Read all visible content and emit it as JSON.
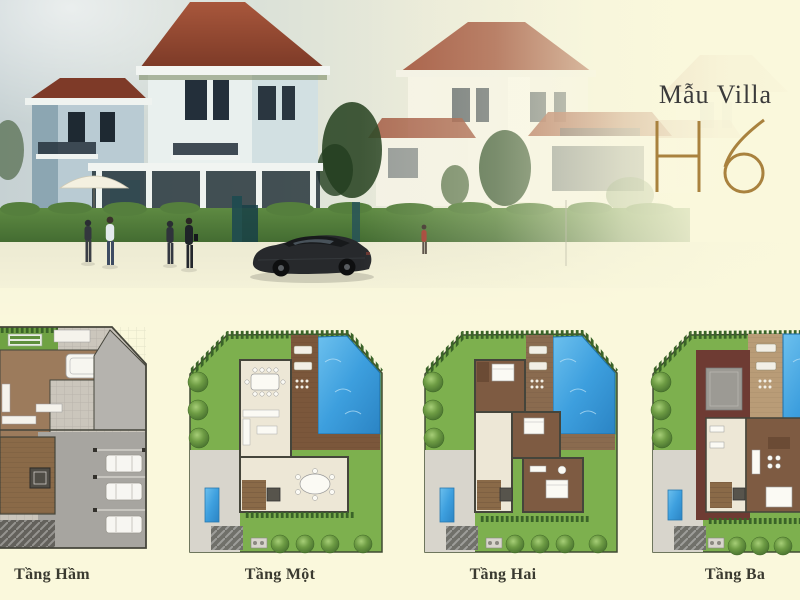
{
  "header": {
    "brand": "Mẫu Villa",
    "model": "H6"
  },
  "floors": [
    {
      "id": "basement",
      "label": "Tầng Hầm"
    },
    {
      "id": "first-floor",
      "label": "Tầng Một"
    },
    {
      "id": "second-floor",
      "label": "Tầng Hai"
    },
    {
      "id": "third-floor",
      "label": "Tầng Ba"
    }
  ],
  "colors": {
    "background_cream": "#FAF8DC",
    "accent_gold": "#A9823E",
    "title_text": "#3B3B3B",
    "label_text": "#3A3A30",
    "roof_red": "#8E4230",
    "maroon_roof": "#6E3B33",
    "lawn_green": "#7DB04E",
    "hedge_green": "#3A6428",
    "pool_blue": "#3D9FDE",
    "deck_brown": "#7B573B",
    "bedroom_brown": "#7E5B42",
    "interior_cream": "#EDE7D6",
    "garage_gray": "#A7A5A0",
    "sky_gray": "#C6D1D3"
  }
}
